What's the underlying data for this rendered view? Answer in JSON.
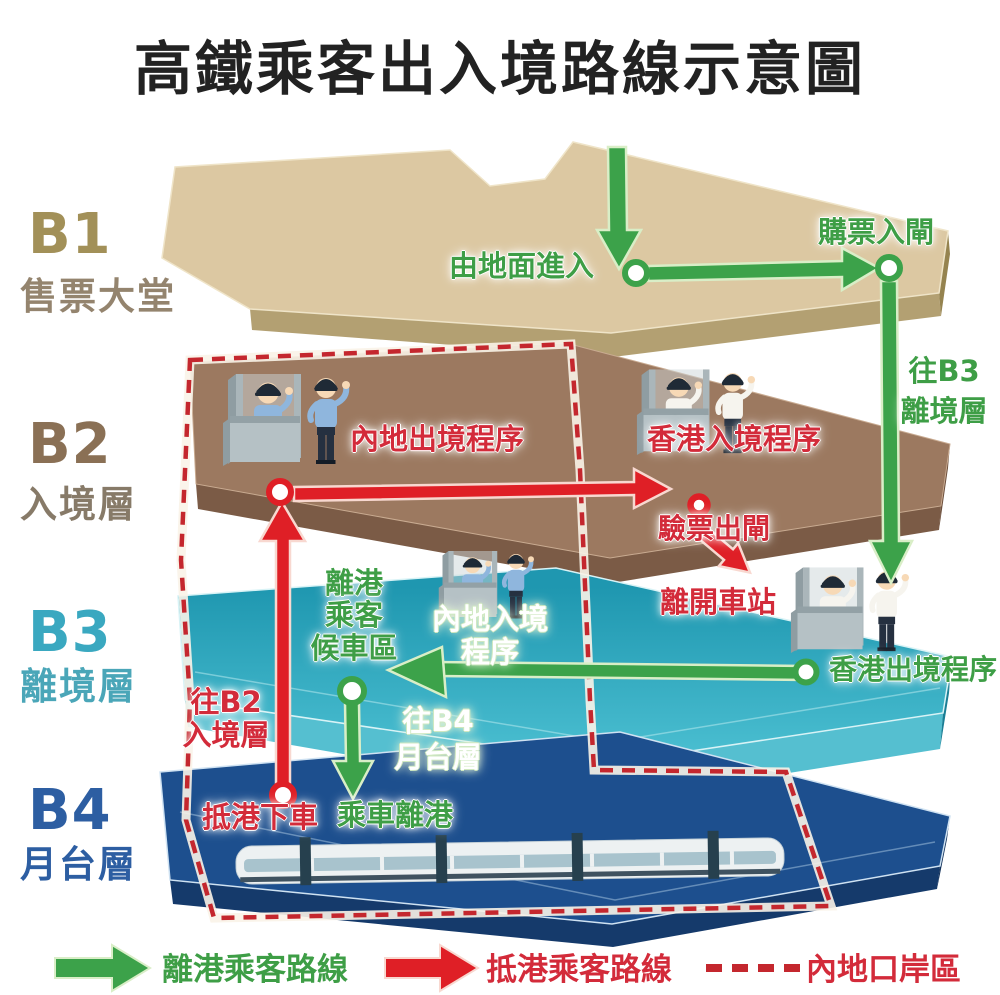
{
  "title": "高鐵乘客出入境路線示意圖",
  "floors": [
    {
      "code": "B1",
      "name": "售票大堂",
      "code_color": "#a29058",
      "name_color": "#94846e"
    },
    {
      "code": "B2",
      "name": "入境層",
      "code_color": "#8a7055",
      "name_color": "#877a68"
    },
    {
      "code": "B3",
      "name": "離境層",
      "code_color": "#3aa8c0",
      "name_color": "#4aa6b8"
    },
    {
      "code": "B4",
      "name": "月台層",
      "code_color": "#2d5ea2",
      "name_color": "#2d5ea2"
    }
  ],
  "route_labels": {
    "enter_from_ground": "由地面進入",
    "buy_ticket_enter_gate": "購票入閘",
    "to_b3_line1": "往B3",
    "to_b3_line2": "離境層",
    "mainland_exit_procedure": "內地出境程序",
    "hk_entry_procedure": "香港入境程序",
    "ticket_check_exit_gate": "驗票出閘",
    "leave_station": "離開車站",
    "waiting_line1": "離港",
    "waiting_line2": "乘客",
    "waiting_line3": "候車區",
    "mainland_entry_line1": "內地入境",
    "mainland_entry_line2": "程序",
    "hk_exit_procedure": "香港出境程序",
    "to_b4_line1": "往B4",
    "to_b4_line2": "月台層",
    "to_b2_line1": "往B2",
    "to_b2_line2": "入境層",
    "arrive_alight": "抵港下車",
    "board_depart": "乘車離港"
  },
  "legend": {
    "departing_route": "離港乘客路線",
    "arriving_route": "抵港乘客路線",
    "mainland_port_area": "內地口岸區"
  },
  "colors": {
    "green_route": "#3ca24a",
    "red_route": "#df1f26",
    "dashed_boundary": "#c4272e",
    "floor_b1_top": "#dcc8a2",
    "floor_b2_top": "#9c7960",
    "floor_b3_top": "#2ba6bd",
    "floor_b4_top": "#1d4f8e"
  }
}
